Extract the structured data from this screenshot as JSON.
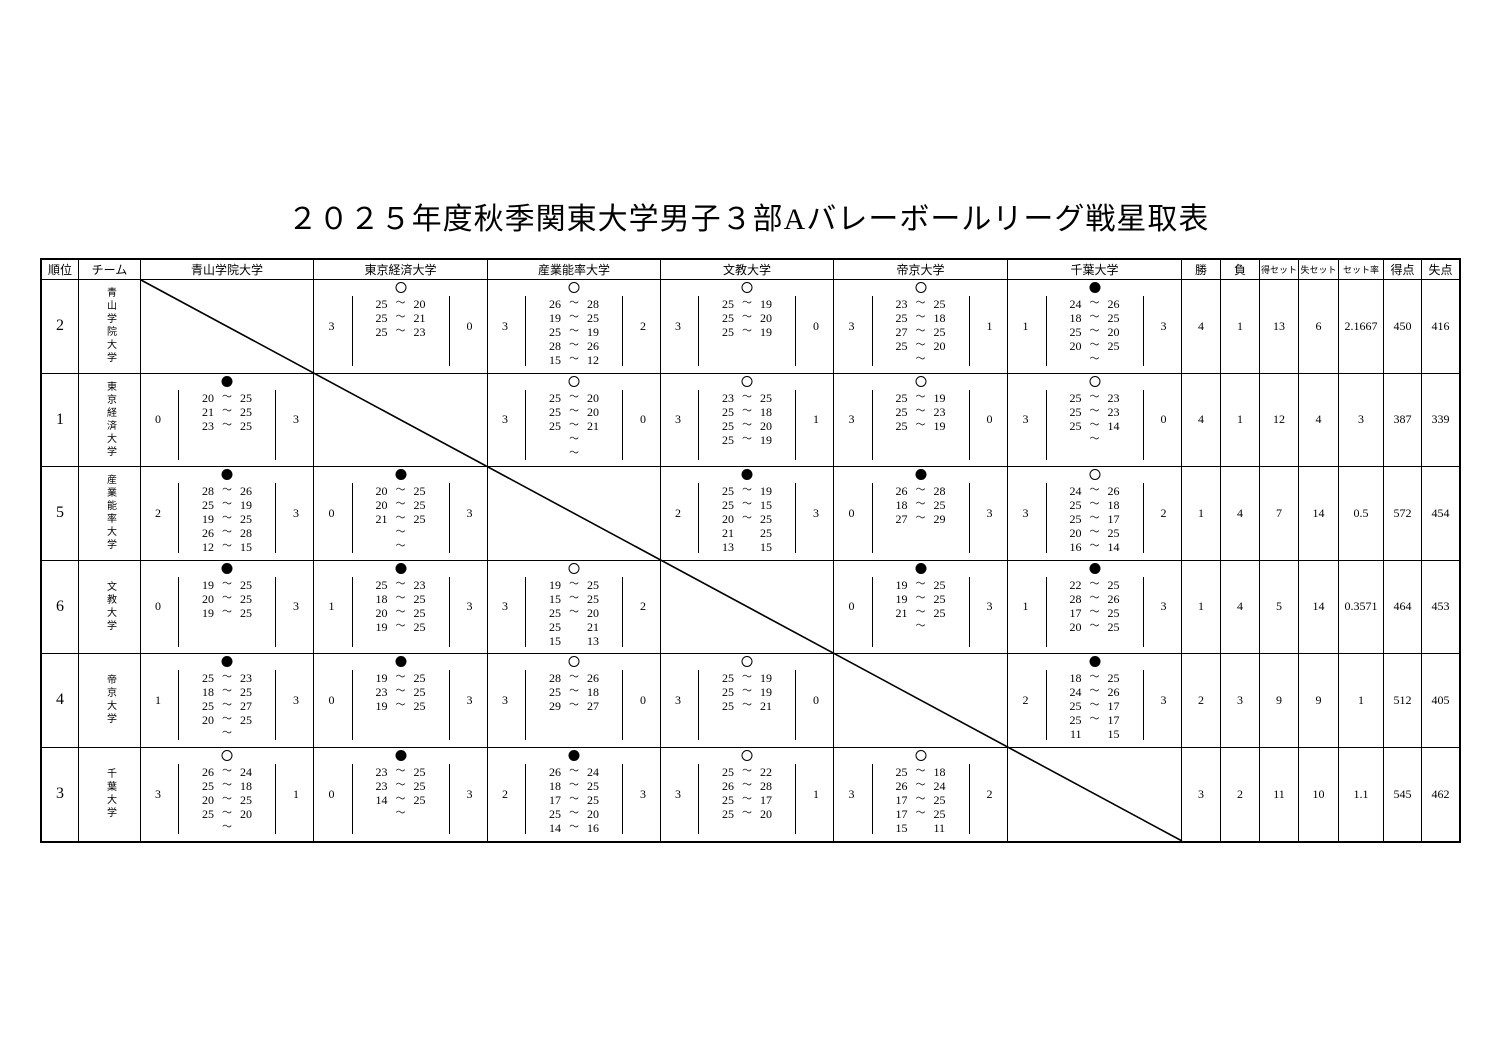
{
  "title": "２０２５年度秋季関東大学男子３部Aバレーボールリーグ戦星取表",
  "marks": {
    "win": "○",
    "loss": "●"
  },
  "table": {
    "corner_headers": [
      "順位",
      "チーム"
    ],
    "opponent_headers": [
      "青山学院大学",
      "東京経済大学",
      "産業能率大学",
      "文教大学",
      "帝京大学",
      "千葉大学"
    ],
    "stat_headers": [
      "勝",
      "負",
      "得セット",
      "失セット",
      "セット率",
      "得点",
      "失点"
    ],
    "rows": [
      {
        "rank": "2",
        "team": "青山学院大学",
        "cells": [
          {
            "self": true
          },
          {
            "result": "win",
            "left": "3",
            "right": "0",
            "sets": [
              [
                "25",
                "～",
                "20"
              ],
              [
                "25",
                "～",
                "21"
              ],
              [
                "25",
                "～",
                "23"
              ]
            ]
          },
          {
            "result": "win",
            "left": "3",
            "right": "2",
            "sets": [
              [
                "26",
                "～",
                "28"
              ],
              [
                "19",
                "～",
                "25"
              ],
              [
                "25",
                "～",
                "19"
              ],
              [
                "28",
                "～",
                "26"
              ],
              [
                "15",
                "～",
                "12"
              ]
            ]
          },
          {
            "result": "win",
            "left": "3",
            "right": "0",
            "sets": [
              [
                "25",
                "～",
                "19"
              ],
              [
                "25",
                "～",
                "20"
              ],
              [
                "25",
                "～",
                "19"
              ]
            ]
          },
          {
            "result": "win",
            "left": "3",
            "right": "1",
            "sets": [
              [
                "23",
                "～",
                "25"
              ],
              [
                "25",
                "～",
                "18"
              ],
              [
                "27",
                "～",
                "25"
              ],
              [
                "25",
                "～",
                "20"
              ],
              [
                "",
                "～",
                ""
              ]
            ]
          },
          {
            "result": "loss",
            "left": "1",
            "right": "3",
            "sets": [
              [
                "24",
                "～",
                "26"
              ],
              [
                "18",
                "～",
                "25"
              ],
              [
                "25",
                "～",
                "20"
              ],
              [
                "20",
                "～",
                "25"
              ],
              [
                "",
                "～",
                ""
              ]
            ]
          }
        ],
        "stats": [
          "4",
          "1",
          "13",
          "6",
          "2.1667",
          "450",
          "416"
        ]
      },
      {
        "rank": "1",
        "team": "東京経済大学",
        "cells": [
          {
            "result": "loss",
            "left": "0",
            "right": "3",
            "sets": [
              [
                "20",
                "～",
                "25"
              ],
              [
                "21",
                "～",
                "25"
              ],
              [
                "23",
                "～",
                "25"
              ]
            ]
          },
          {
            "self": true
          },
          {
            "result": "win",
            "left": "3",
            "right": "0",
            "sets": [
              [
                "25",
                "～",
                "20"
              ],
              [
                "25",
                "～",
                "20"
              ],
              [
                "25",
                "～",
                "21"
              ],
              [
                "",
                "～",
                ""
              ],
              [
                "",
                "～",
                ""
              ]
            ]
          },
          {
            "result": "win",
            "left": "3",
            "right": "1",
            "sets": [
              [
                "23",
                "～",
                "25"
              ],
              [
                "25",
                "～",
                "18"
              ],
              [
                "25",
                "～",
                "20"
              ],
              [
                "25",
                "～",
                "19"
              ]
            ]
          },
          {
            "result": "win",
            "left": "3",
            "right": "0",
            "sets": [
              [
                "25",
                "～",
                "19"
              ],
              [
                "25",
                "～",
                "23"
              ],
              [
                "25",
                "～",
                "19"
              ]
            ]
          },
          {
            "result": "win",
            "left": "3",
            "right": "0",
            "sets": [
              [
                "25",
                "～",
                "23"
              ],
              [
                "25",
                "～",
                "23"
              ],
              [
                "25",
                "～",
                "14"
              ],
              [
                "",
                "～",
                ""
              ]
            ]
          }
        ],
        "stats": [
          "4",
          "1",
          "12",
          "4",
          "3",
          "387",
          "339"
        ]
      },
      {
        "rank": "5",
        "team": "産業能率大学",
        "cells": [
          {
            "result": "loss",
            "left": "2",
            "right": "3",
            "sets": [
              [
                "28",
                "～",
                "26"
              ],
              [
                "25",
                "～",
                "19"
              ],
              [
                "19",
                "～",
                "25"
              ],
              [
                "26",
                "～",
                "28"
              ],
              [
                "12",
                "～",
                "15"
              ]
            ]
          },
          {
            "result": "loss",
            "left": "0",
            "right": "3",
            "sets": [
              [
                "20",
                "～",
                "25"
              ],
              [
                "20",
                "～",
                "25"
              ],
              [
                "21",
                "～",
                "25"
              ],
              [
                "",
                "～",
                ""
              ],
              [
                "",
                "～",
                ""
              ]
            ]
          },
          {
            "self": true
          },
          {
            "result": "loss",
            "left": "2",
            "right": "3",
            "sets": [
              [
                "25",
                "～",
                "19"
              ],
              [
                "25",
                "～",
                "15"
              ],
              [
                "20",
                "～",
                "25"
              ],
              [
                "21",
                "",
                "25"
              ],
              [
                "13",
                "",
                "15"
              ]
            ]
          },
          {
            "result": "loss",
            "left": "0",
            "right": "3",
            "sets": [
              [
                "26",
                "～",
                "28"
              ],
              [
                "18",
                "～",
                "25"
              ],
              [
                "27",
                "～",
                "29"
              ]
            ]
          },
          {
            "result": "win",
            "left": "3",
            "right": "2",
            "sets": [
              [
                "24",
                "～",
                "26"
              ],
              [
                "25",
                "～",
                "18"
              ],
              [
                "25",
                "～",
                "17"
              ],
              [
                "20",
                "～",
                "25"
              ],
              [
                "16",
                "～",
                "14"
              ]
            ]
          }
        ],
        "stats": [
          "1",
          "4",
          "7",
          "14",
          "0.5",
          "572",
          "454"
        ]
      },
      {
        "rank": "6",
        "team": "文教大学",
        "cells": [
          {
            "result": "loss",
            "left": "0",
            "right": "3",
            "sets": [
              [
                "19",
                "～",
                "25"
              ],
              [
                "20",
                "～",
                "25"
              ],
              [
                "19",
                "～",
                "25"
              ]
            ]
          },
          {
            "result": "loss",
            "left": "1",
            "right": "3",
            "sets": [
              [
                "25",
                "～",
                "23"
              ],
              [
                "18",
                "～",
                "25"
              ],
              [
                "20",
                "～",
                "25"
              ],
              [
                "19",
                "～",
                "25"
              ]
            ]
          },
          {
            "result": "win",
            "left": "3",
            "right": "2",
            "sets": [
              [
                "19",
                "～",
                "25"
              ],
              [
                "15",
                "～",
                "25"
              ],
              [
                "25",
                "～",
                "20"
              ],
              [
                "25",
                "",
                "21"
              ],
              [
                "15",
                "",
                "13"
              ]
            ]
          },
          {
            "self": true
          },
          {
            "result": "loss",
            "left": "0",
            "right": "3",
            "sets": [
              [
                "19",
                "～",
                "25"
              ],
              [
                "19",
                "～",
                "25"
              ],
              [
                "21",
                "～",
                "25"
              ],
              [
                "",
                "～",
                ""
              ]
            ]
          },
          {
            "result": "loss",
            "left": "1",
            "right": "3",
            "sets": [
              [
                "22",
                "～",
                "25"
              ],
              [
                "28",
                "～",
                "26"
              ],
              [
                "17",
                "～",
                "25"
              ],
              [
                "20",
                "～",
                "25"
              ]
            ]
          }
        ],
        "stats": [
          "1",
          "4",
          "5",
          "14",
          "0.3571",
          "464",
          "453"
        ]
      },
      {
        "rank": "4",
        "team": "帝京大学",
        "cells": [
          {
            "result": "loss",
            "left": "1",
            "right": "3",
            "sets": [
              [
                "25",
                "～",
                "23"
              ],
              [
                "18",
                "～",
                "25"
              ],
              [
                "25",
                "～",
                "27"
              ],
              [
                "20",
                "～",
                "25"
              ],
              [
                "",
                "～",
                ""
              ]
            ]
          },
          {
            "result": "loss",
            "left": "0",
            "right": "3",
            "sets": [
              [
                "19",
                "～",
                "25"
              ],
              [
                "23",
                "～",
                "25"
              ],
              [
                "19",
                "～",
                "25"
              ]
            ]
          },
          {
            "result": "win",
            "left": "3",
            "right": "0",
            "sets": [
              [
                "28",
                "～",
                "26"
              ],
              [
                "25",
                "～",
                "18"
              ],
              [
                "29",
                "～",
                "27"
              ]
            ]
          },
          {
            "result": "win",
            "left": "3",
            "right": "0",
            "sets": [
              [
                "25",
                "～",
                "19"
              ],
              [
                "25",
                "～",
                "19"
              ],
              [
                "25",
                "～",
                "21"
              ]
            ]
          },
          {
            "self": true
          },
          {
            "result": "loss",
            "left": "2",
            "right": "3",
            "sets": [
              [
                "18",
                "～",
                "25"
              ],
              [
                "24",
                "～",
                "26"
              ],
              [
                "25",
                "～",
                "17"
              ],
              [
                "25",
                "～",
                "17"
              ],
              [
                "11",
                "",
                "15"
              ]
            ]
          }
        ],
        "stats": [
          "2",
          "3",
          "9",
          "9",
          "1",
          "512",
          "405"
        ]
      },
      {
        "rank": "3",
        "team": "千葉大学",
        "cells": [
          {
            "result": "win",
            "left": "3",
            "right": "1",
            "sets": [
              [
                "26",
                "～",
                "24"
              ],
              [
                "25",
                "～",
                "18"
              ],
              [
                "20",
                "～",
                "25"
              ],
              [
                "25",
                "～",
                "20"
              ],
              [
                "",
                "～",
                ""
              ]
            ]
          },
          {
            "result": "loss",
            "left": "0",
            "right": "3",
            "sets": [
              [
                "23",
                "～",
                "25"
              ],
              [
                "23",
                "～",
                "25"
              ],
              [
                "14",
                "～",
                "25"
              ],
              [
                "",
                "～",
                ""
              ]
            ]
          },
          {
            "result": "loss",
            "left": "2",
            "right": "3",
            "sets": [
              [
                "26",
                "～",
                "24"
              ],
              [
                "18",
                "～",
                "25"
              ],
              [
                "17",
                "～",
                "25"
              ],
              [
                "25",
                "～",
                "20"
              ],
              [
                "14",
                "～",
                "16"
              ]
            ]
          },
          {
            "result": "win",
            "left": "3",
            "right": "1",
            "sets": [
              [
                "25",
                "～",
                "22"
              ],
              [
                "26",
                "～",
                "28"
              ],
              [
                "25",
                "～",
                "17"
              ],
              [
                "25",
                "～",
                "20"
              ]
            ]
          },
          {
            "result": "win",
            "left": "3",
            "right": "2",
            "sets": [
              [
                "25",
                "～",
                "18"
              ],
              [
                "26",
                "～",
                "24"
              ],
              [
                "17",
                "～",
                "25"
              ],
              [
                "17",
                "～",
                "25"
              ],
              [
                "15",
                "",
                "11"
              ]
            ]
          },
          {
            "self": true
          }
        ],
        "stats": [
          "3",
          "2",
          "11",
          "10",
          "1.1",
          "545",
          "462"
        ]
      }
    ]
  }
}
